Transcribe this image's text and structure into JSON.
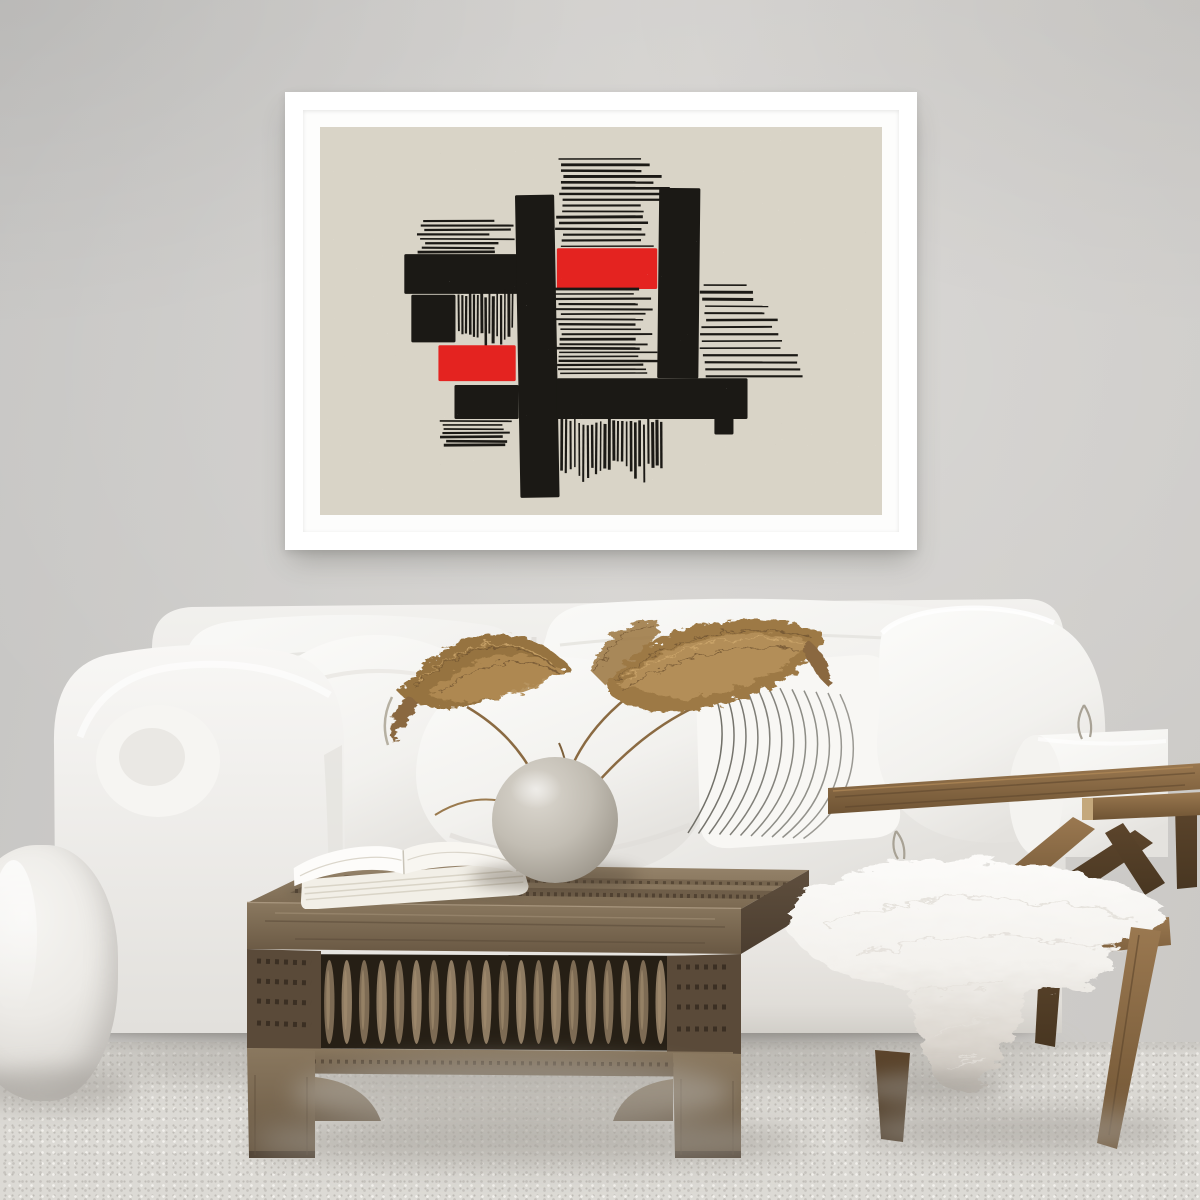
{
  "scene": {
    "description": "Bright living room: abstract black and red block print in a white frame on a gray wall above a white slipcovered sofa with pillows, dried pampas grass in a round stone vase and books on a carved wood coffee table, wooden lounge chair with white sheepskin throw, white knitted pouf, light speckled carpet",
    "room_type": "living room"
  },
  "css_vars": {
    "--wall": "#cecdca",
    "--carpet": "#dcdad5",
    "--paper": "#d9d4c7"
  },
  "artwork": {
    "style": "abstract linocut blocks and stripes",
    "frame_color": "#ffffff",
    "mat_color": "#fdfdfc",
    "paper_color": "#d9d4c7",
    "palette": {
      "ink": "#1b1915",
      "red": "#e42320"
    },
    "canvas": {
      "width": 560,
      "height": 400
    },
    "elements": [
      {
        "id": "stripes-upper-left",
        "type": "hstripes",
        "x": 100,
        "y": 97,
        "w": 94,
        "h": 34,
        "lines": 8
      },
      {
        "id": "block-left-wide",
        "type": "rect",
        "x": 84,
        "y": 131,
        "w": 118,
        "h": 41
      },
      {
        "id": "block-left-small",
        "type": "rect",
        "x": 91,
        "y": 173,
        "w": 44,
        "h": 49
      },
      {
        "id": "stripes-left-vertical",
        "type": "vstripes",
        "x": 138,
        "y": 171,
        "w": 56,
        "h": 52,
        "lines": 15
      },
      {
        "id": "red-block-left",
        "type": "rect",
        "color": "red",
        "x": 118,
        "y": 225,
        "w": 77,
        "h": 37
      },
      {
        "id": "block-left-lower",
        "type": "rect",
        "x": 134,
        "y": 266,
        "w": 64,
        "h": 35
      },
      {
        "id": "stripes-lower-left",
        "type": "hstripes",
        "x": 122,
        "y": 303,
        "w": 74,
        "h": 27,
        "lines": 7
      },
      {
        "id": "bar-vertical-main",
        "type": "rect",
        "x": 197,
        "y": 70,
        "w": 39,
        "h": 312,
        "tilt": -1
      },
      {
        "id": "stripes-top-center",
        "type": "hstripes",
        "x": 238,
        "y": 33,
        "w": 106,
        "h": 92,
        "lines": 16
      },
      {
        "id": "red-block-center",
        "type": "rect",
        "color": "red",
        "x": 236,
        "y": 125,
        "w": 100,
        "h": 42
      },
      {
        "id": "stripes-center",
        "type": "hstripes",
        "x": 236,
        "y": 167,
        "w": 100,
        "h": 59,
        "lines": 12
      },
      {
        "id": "stripes-center-dense",
        "type": "hstripes",
        "x": 236,
        "y": 228,
        "w": 100,
        "h": 28,
        "lines": 7
      },
      {
        "id": "bar-vertical-right",
        "type": "rect",
        "x": 337,
        "y": 63,
        "w": 41,
        "h": 196,
        "tilt": 0.6
      },
      {
        "id": "stripes-right",
        "type": "hstripes",
        "x": 380,
        "y": 163,
        "w": 95,
        "h": 96,
        "lines": 14,
        "stepped": true
      },
      {
        "id": "bar-bottom",
        "type": "rect",
        "x": 236,
        "y": 259,
        "w": 190,
        "h": 42
      },
      {
        "id": "stripes-bottom-vertical",
        "type": "vstripes",
        "x": 241,
        "y": 303,
        "w": 101,
        "h": 59,
        "lines": 24
      },
      {
        "id": "block-bottom-small",
        "type": "rect",
        "x": 393,
        "y": 300,
        "w": 19,
        "h": 17
      }
    ]
  },
  "furniture": {
    "sofa": {
      "type": "white slipcovered sofa",
      "fabric_color": "#f3f2ef",
      "pillow_count": 5,
      "striped_pillow": {
        "stripe_count": 12,
        "stripe_color": "#63625a"
      }
    },
    "coffee_table": {
      "style": "carved moroccan wood coffee table",
      "wood_color": "#82705a",
      "spindle_count": 26
    },
    "chair": {
      "style": "angled wood lounge chair",
      "wood_color": "#7c5e3e",
      "throw": "white sheepskin"
    },
    "pouf": {
      "color": "#efeeeb"
    },
    "vase": {
      "shape": "sphere",
      "material": "stone",
      "color": "#b9b4aa"
    },
    "plant": {
      "type": "dried pampas grass",
      "color": "#9a7747"
    },
    "books": {
      "count": 2,
      "color": "#f4f1e8"
    },
    "carpet": {
      "color": "#dcdad5"
    }
  }
}
